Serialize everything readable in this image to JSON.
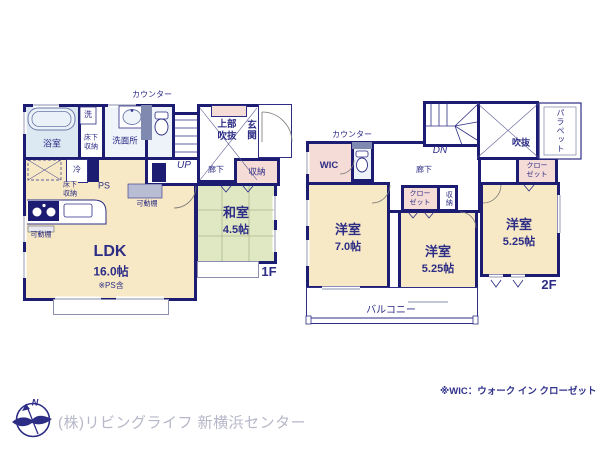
{
  "floor1": {
    "floor_label": "1F",
    "counter_label": "カウンター",
    "bath": "浴室",
    "washer": "洗",
    "underfloor_a": "床下収納",
    "vanity": "洗面所",
    "upper_void": "上部吹抜",
    "entrance": "玄関",
    "stairs_up": "UP",
    "hallway": "廊下",
    "storage": "収納",
    "fridge": "冷",
    "ps": "PS",
    "underfloor_b": "床下収納",
    "shelf_a": "可動棚",
    "shelf_b": "可動棚",
    "ldk_name": "LDK",
    "ldk_size": "16.0帖",
    "ldk_note": "※PS含",
    "washitsu_name": "和室",
    "washitsu_size": "4.5帖"
  },
  "floor2": {
    "floor_label": "2F",
    "counter_label": "カウンター",
    "wic": "WIC",
    "stairs_down": "DN",
    "hallway": "廊下",
    "void": "吹抜",
    "parapet": "パラペット",
    "closet_right": "クローゼット",
    "closet_mid": "クローゼット",
    "storage": "収納",
    "room_a_name": "洋室",
    "room_a_size": "7.0帖",
    "room_b_name": "洋室",
    "room_b_size": "5.25帖",
    "room_c_name": "洋室",
    "room_c_size": "5.25帖",
    "balcony": "バルコニー"
  },
  "footer": {
    "compass_north": "N",
    "company": "(株)リビングライフ 新横浜センター",
    "wic_note": "※WIC：ウォーク イン クローゼット"
  },
  "colors": {
    "wall_navy": "#1c1c72",
    "room_beige": "#f7e9c5",
    "tatami_green": "#e0e8c3",
    "wet_area_blue": "#dce8f2",
    "closet_pink": "#f6dcd6",
    "fixture_slate": "#8089b0",
    "company_gray": "#b6b7c8",
    "note_navy": "#31318c"
  }
}
